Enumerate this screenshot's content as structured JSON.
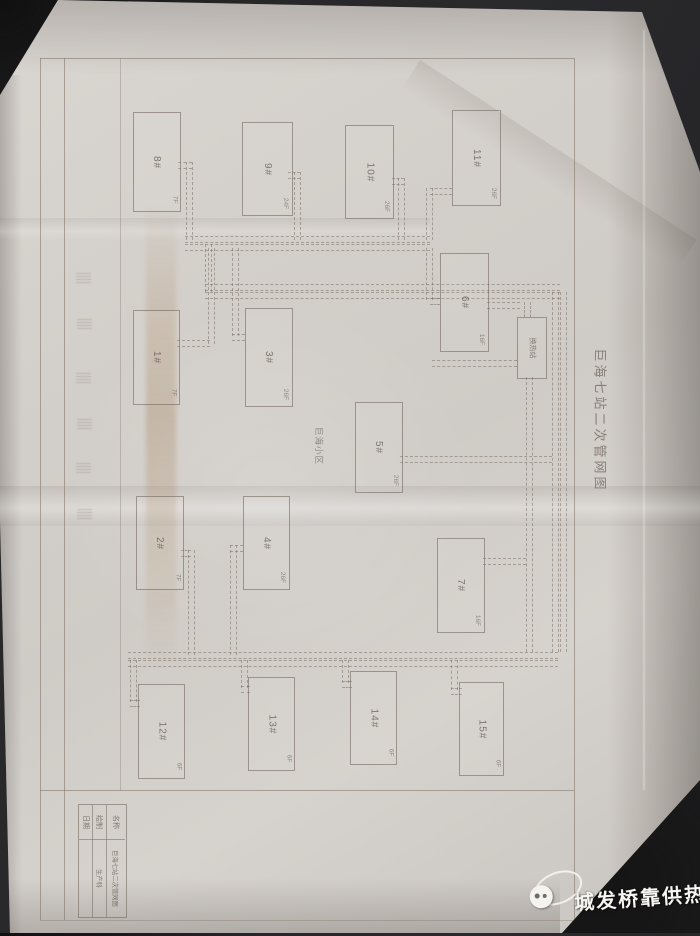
{
  "photo": {
    "sheet_title": "巨海七站二次管网图",
    "area_label": "巨海小区",
    "station_label": "换热站",
    "title_block": {
      "name_label": "名称",
      "name_value": "巨海七站二次管网图",
      "drawn_label": "绘制",
      "drawn_value": "生产科",
      "date_label": "日期",
      "date_value": ""
    },
    "buildings": [
      {
        "label": "8#",
        "floors": "7F"
      },
      {
        "label": "9#",
        "floors": "24F"
      },
      {
        "label": "10#",
        "floors": "26F"
      },
      {
        "label": "11#",
        "floors": "26F"
      },
      {
        "label": "6#",
        "floors": "16F"
      },
      {
        "label": "1#",
        "floors": "7F"
      },
      {
        "label": "3#",
        "floors": "26F"
      },
      {
        "label": "5#",
        "floors": "26F"
      },
      {
        "label": "2#",
        "floors": "7F"
      },
      {
        "label": "4#",
        "floors": "26F"
      },
      {
        "label": "7#",
        "floors": "16F"
      },
      {
        "label": "12#",
        "floors": "6F"
      },
      {
        "label": "13#",
        "floors": "6F"
      },
      {
        "label": "14#",
        "floors": "6F"
      },
      {
        "label": "15#",
        "floors": "6F"
      }
    ],
    "watermark": {
      "text": "城发桥靠供热"
    },
    "colors": {
      "paper": "#d3cfca",
      "line": "#7a7067",
      "watermark_text": "#f7f5f1"
    }
  }
}
